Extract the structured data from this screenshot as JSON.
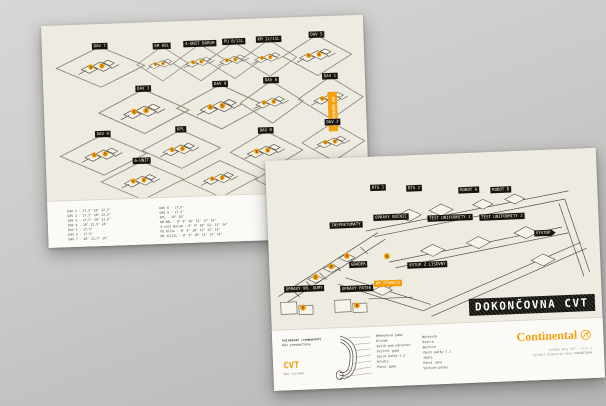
{
  "back_poster": {
    "tiles": [
      "DAV 7",
      "KM 08L",
      "4-UNIT BARUM",
      "PU 8/11L",
      "KM 12/11L",
      "DAV 5",
      "DAV 3",
      "DAV 9",
      "DAV 6",
      "DAV 1",
      "DAV 4",
      "KPL",
      "DAV 8",
      "DAV 2",
      "6-UNIT"
    ],
    "side_tag": "KM DOPRAVNÍK",
    "legend": {
      "col1": [
        "DAV 1 - 17,5\" 20\" 22,5\"",
        "DAV 2 - 17,5\" 20\" 22,5\"",
        "DAV 3 - 17,5\" 20\" 22,5\"",
        "DAV 4 - 20\" 22,5\" 24\"",
        "DAV 5 - 17,5\"",
        "DAV 6 - 17,5\"",
        "DAV 7 - 20\" 22,5\" 24\""
      ],
      "col2": [
        "DAV 8 - 17,5\"",
        "DAV 9 - 17,5\"",
        "KPL - 18\" 20\"",
        "KM 08L - 8\" 9\" 10\" 12\" 13\" 14\"",
        "4-unit Barum - 8\" 9\" 10\" 12\" 13\" 14\"",
        "PU 8/11L - 8\" 9\" 10\" 12\" 13\" 14\"",
        "KM 12/11L - 8\" 9\" 10\" 12\" 13\" 14\""
      ],
      "groups": [
        "DAV 1,2,3,4,7,PU/S",
        "DAV 5,6,8,9",
        "KM 08L, 4-unit Barum, PU 8/11L, KM 12/11L"
      ]
    }
  },
  "front_poster": {
    "labels": {
      "rtg1": "RTG 1",
      "rtg2": "RTG 2",
      "robot_a": "ROBOT A",
      "robot_b": "ROBOT B",
      "opravy_bocnic": "OPRAVY BOČNIC",
      "test1": "TEST UNIFORMITY 1",
      "test2": "TEST UNIFORMITY 2",
      "inspektomaty": "INSPEKTOMATY",
      "vystup": "VÝSTUP",
      "grader": "GRADER",
      "vstup": "VSTUP Z LISOVNY",
      "opravy_vn_gumy": "OPRAVY VN. GUMY",
      "opravy_patek": "OPRAVY PATEK",
      "km_stanice": "KM STANICE"
    },
    "title": "DOKONČOVNA CVT",
    "tire_legend": {
      "heading": "Polohovač (component)",
      "subheading": "Řez pneumatikou",
      "left": [
        "Běhounová guma",
        "Klínek",
        "Vpich pod nárazník",
        "Vnitřní guma",
        "Vpich patky č.2",
        "Křídla",
        "Patní guma"
      ],
      "right": [
        "Nárazník",
        "Kostra",
        "Bočnice",
        "Vpich patky č.1",
        "Jádra",
        "Patní lana",
        "Výztuže patky"
      ],
      "cvt": "CVT",
      "cvt_sub": "Náš výrobek"
    },
    "brand": {
      "name": "Continental",
      "note1": "schéma haly CVT — list 1",
      "note2": "výrobní dispozice haly DOKONČOVNA"
    }
  },
  "colors": {
    "accent_orange": "#f59b00",
    "label_black": "#17150f",
    "poster_cream": "#edeae0"
  }
}
